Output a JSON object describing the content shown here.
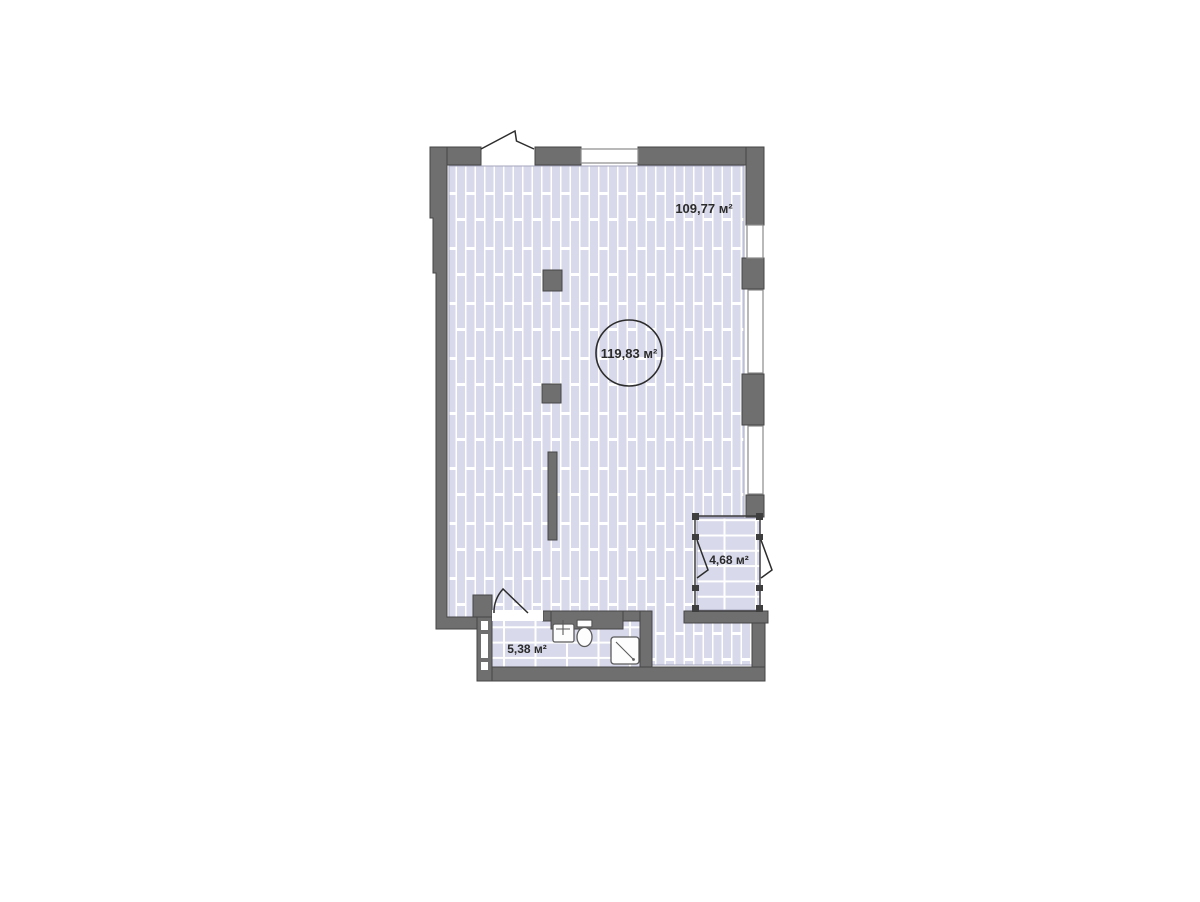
{
  "floor_plan": {
    "unit": "м²",
    "labels": {
      "main_area": "109,77 м²",
      "total_area": "119,83 м²",
      "loggia_area": "4,68 м²",
      "bathroom_area": "5,38 м²"
    },
    "colors": {
      "bg": "#ffffff",
      "wall": "#6f6f6f",
      "wall_line": "#454545",
      "floor": "#d8d9ea",
      "floor_line": "#a6a6bf",
      "win": "#8a8a8a",
      "line": "#2d2d2d",
      "fix": "#5a5a5a",
      "text": "#2b2b2b"
    }
  }
}
